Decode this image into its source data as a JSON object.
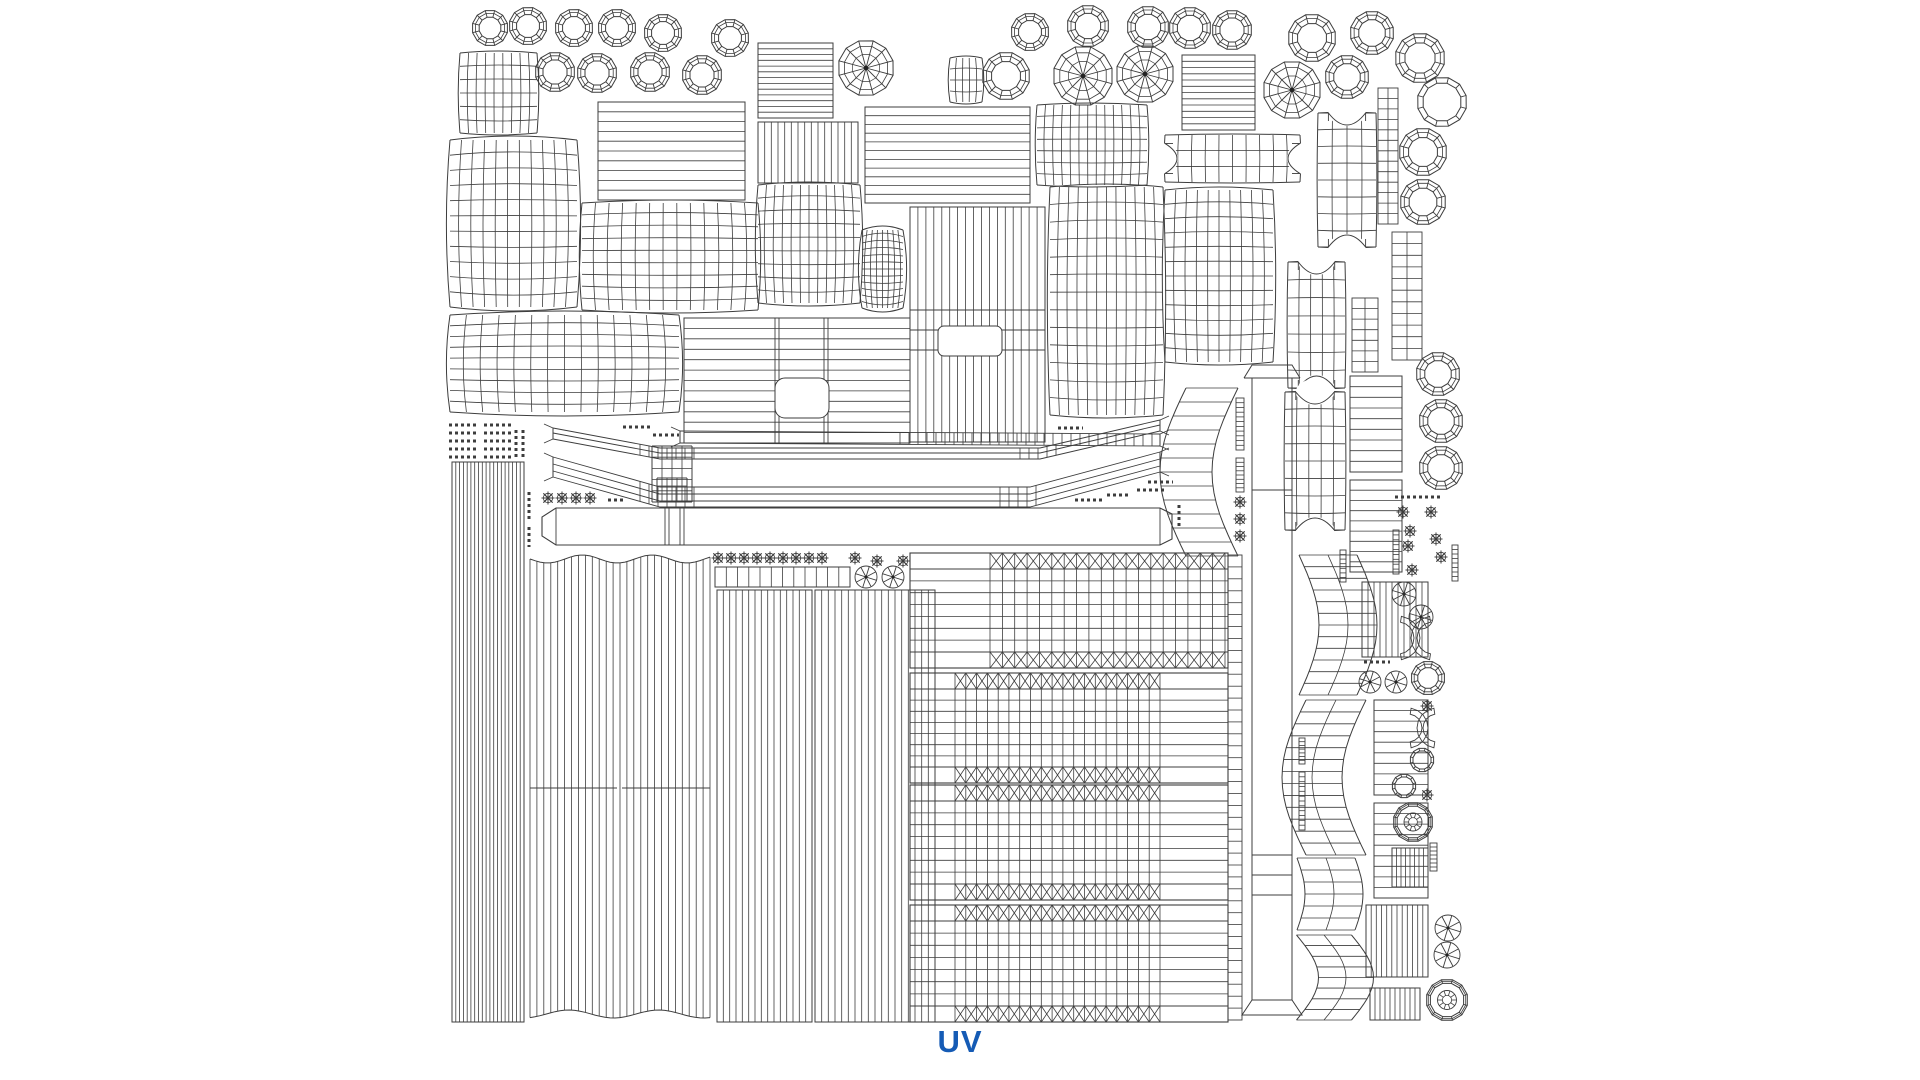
{
  "page": {
    "background": "#ffffff",
    "line_color": "#3d3d3d",
    "label": {
      "text": "UV",
      "color": "#155bb5"
    }
  },
  "canvas": {
    "width": 1920,
    "height": 1080,
    "shapes": [
      {
        "t": "ring",
        "x": 490,
        "y": 28,
        "r": 18
      },
      {
        "t": "ring",
        "x": 528,
        "y": 26,
        "r": 19
      },
      {
        "t": "ring",
        "x": 574,
        "y": 28,
        "r": 19
      },
      {
        "t": "ring",
        "x": 617,
        "y": 28,
        "r": 19
      },
      {
        "t": "ring",
        "x": 663,
        "y": 33,
        "r": 19
      },
      {
        "t": "ring",
        "x": 730,
        "y": 38,
        "r": 19
      },
      {
        "t": "ring",
        "x": 555,
        "y": 72,
        "r": 20
      },
      {
        "t": "ring",
        "x": 597,
        "y": 73,
        "r": 20
      },
      {
        "t": "ring",
        "x": 650,
        "y": 72,
        "r": 20
      },
      {
        "t": "ring",
        "x": 702,
        "y": 75,
        "r": 20
      },
      {
        "t": "ring",
        "x": 1030,
        "y": 32,
        "r": 19
      },
      {
        "t": "ring",
        "x": 1088,
        "y": 26,
        "r": 21
      },
      {
        "t": "ring",
        "x": 1148,
        "y": 27,
        "r": 21
      },
      {
        "t": "ring",
        "x": 1190,
        "y": 28,
        "r": 21
      },
      {
        "t": "ring",
        "x": 1232,
        "y": 30,
        "r": 20
      },
      {
        "t": "ring",
        "x": 1312,
        "y": 38,
        "r": 24
      },
      {
        "t": "ring",
        "x": 1372,
        "y": 33,
        "r": 22
      },
      {
        "t": "ring",
        "x": 1347,
        "y": 77,
        "r": 22
      },
      {
        "t": "ring",
        "x": 1420,
        "y": 58,
        "r": 25
      },
      {
        "t": "ring",
        "x": 1423,
        "y": 152,
        "r": 24
      },
      {
        "t": "ring",
        "x": 1423,
        "y": 202,
        "r": 23
      },
      {
        "t": "ring",
        "x": 1006,
        "y": 76,
        "r": 24
      },
      {
        "t": "ring",
        "x": 1438,
        "y": 374,
        "r": 22
      },
      {
        "t": "ring",
        "x": 1441,
        "y": 421,
        "r": 22
      },
      {
        "t": "ring",
        "x": 1441,
        "y": 468,
        "r": 22
      },
      {
        "t": "ring",
        "x": 1428,
        "y": 678,
        "r": 17
      },
      {
        "t": "ringp",
        "x": 1442,
        "y": 102,
        "r": 25
      },
      {
        "t": "ringp",
        "x": 1422,
        "y": 760,
        "r": 12
      },
      {
        "t": "ringp",
        "x": 1404,
        "y": 786,
        "r": 12
      },
      {
        "t": "bearing",
        "x": 1413,
        "y": 822,
        "r": 20
      },
      {
        "t": "bearing",
        "x": 1447,
        "y": 1000,
        "r": 21
      },
      {
        "t": "wheel",
        "x": 866,
        "y": 68,
        "r": 28
      },
      {
        "t": "wheel",
        "x": 1083,
        "y": 76,
        "r": 30
      },
      {
        "t": "wheel",
        "x": 1145,
        "y": 74,
        "r": 29
      },
      {
        "t": "wheel",
        "x": 1292,
        "y": 90,
        "r": 29
      },
      {
        "t": "wheelS",
        "x": 866,
        "y": 577,
        "r": 11
      },
      {
        "t": "wheelS",
        "x": 893,
        "y": 577,
        "r": 11
      },
      {
        "t": "wheelS",
        "x": 1370,
        "y": 682,
        "r": 11
      },
      {
        "t": "wheelS",
        "x": 1396,
        "y": 682,
        "r": 11
      },
      {
        "t": "wheelS",
        "x": 1404,
        "y": 594,
        "r": 12
      },
      {
        "t": "wheelS",
        "x": 1421,
        "y": 617,
        "r": 12
      },
      {
        "t": "wheelS",
        "x": 1448,
        "y": 928,
        "r": 13
      },
      {
        "t": "wheelS",
        "x": 1447,
        "y": 955,
        "r": 13
      },
      {
        "t": "flower",
        "x": 548,
        "y": 498
      },
      {
        "t": "flower",
        "x": 562,
        "y": 498
      },
      {
        "t": "flower",
        "x": 576,
        "y": 498
      },
      {
        "t": "flower",
        "x": 590,
        "y": 498
      },
      {
        "t": "flower",
        "x": 718,
        "y": 558
      },
      {
        "t": "flower",
        "x": 731,
        "y": 558
      },
      {
        "t": "flower",
        "x": 744,
        "y": 558
      },
      {
        "t": "flower",
        "x": 757,
        "y": 558
      },
      {
        "t": "flower",
        "x": 770,
        "y": 558
      },
      {
        "t": "flower",
        "x": 783,
        "y": 558
      },
      {
        "t": "flower",
        "x": 796,
        "y": 558
      },
      {
        "t": "flower",
        "x": 809,
        "y": 558
      },
      {
        "t": "flower",
        "x": 822,
        "y": 558
      },
      {
        "t": "flower",
        "x": 855,
        "y": 558
      },
      {
        "t": "flower",
        "x": 877,
        "y": 561
      },
      {
        "t": "flower",
        "x": 903,
        "y": 561
      },
      {
        "t": "flower",
        "x": 1240,
        "y": 502
      },
      {
        "t": "flower",
        "x": 1240,
        "y": 519
      },
      {
        "t": "flower",
        "x": 1240,
        "y": 536
      },
      {
        "t": "flower",
        "x": 1317,
        "y": 528
      },
      {
        "t": "flower",
        "x": 1403,
        "y": 512
      },
      {
        "t": "flower",
        "x": 1431,
        "y": 512
      },
      {
        "t": "flower",
        "x": 1410,
        "y": 531
      },
      {
        "t": "flower",
        "x": 1436,
        "y": 539
      },
      {
        "t": "flower",
        "x": 1408,
        "y": 546
      },
      {
        "t": "flower",
        "x": 1441,
        "y": 557
      },
      {
        "t": "flower",
        "x": 1412,
        "y": 570
      },
      {
        "t": "flower",
        "x": 1427,
        "y": 706
      },
      {
        "t": "flower",
        "x": 1427,
        "y": 795
      },
      {
        "t": "grid",
        "x": 460,
        "y": 53,
        "w": 77,
        "h": 80,
        "c": 9,
        "rw": 6,
        "wp": 2
      },
      {
        "t": "grid",
        "x": 450,
        "y": 140,
        "w": 127,
        "h": 167,
        "c": 11,
        "rw": 11,
        "wp": 4
      },
      {
        "t": "grid",
        "x": 582,
        "y": 203,
        "w": 176,
        "h": 107,
        "c": 13,
        "rw": 9,
        "wp": 3
      },
      {
        "t": "grid",
        "x": 758,
        "y": 185,
        "w": 102,
        "h": 118,
        "c": 12,
        "rw": 9,
        "wp": 3
      },
      {
        "t": "grid",
        "x": 862,
        "y": 230,
        "w": 41,
        "h": 78,
        "c": 8,
        "rw": 12,
        "wp": 4
      },
      {
        "t": "grid",
        "x": 1037,
        "y": 105,
        "w": 110,
        "h": 80,
        "c": 13,
        "rw": 7,
        "wp": 2
      },
      {
        "t": "grid",
        "x": 1050,
        "y": 187,
        "w": 113,
        "h": 228,
        "c": 12,
        "rw": 13,
        "wp": 3
      },
      {
        "t": "grid",
        "x": 1165,
        "y": 190,
        "w": 108,
        "h": 172,
        "c": 10,
        "rw": 12,
        "wp": 3
      },
      {
        "t": "grid",
        "x": 450,
        "y": 315,
        "w": 229,
        "h": 97,
        "c": 14,
        "rw": 9,
        "wp": 4
      },
      {
        "t": "grid",
        "x": 950,
        "y": 58,
        "w": 32,
        "h": 44,
        "c": 5,
        "rw": 4,
        "wp": 2
      },
      {
        "t": "grid",
        "x": 652,
        "y": 446,
        "w": 40,
        "h": 56,
        "c": 4,
        "rw": 5,
        "wp": 0
      },
      {
        "t": "grid",
        "x": 657,
        "y": 478,
        "w": 30,
        "h": 24,
        "c": 3,
        "rw": 3,
        "wp": 0
      },
      {
        "t": "hlines",
        "x": 598,
        "y": 102,
        "w": 147,
        "h": 98,
        "n": 9
      },
      {
        "t": "hlines",
        "x": 758,
        "y": 43,
        "w": 75,
        "h": 75,
        "n": 12
      },
      {
        "t": "hlines",
        "x": 865,
        "y": 107,
        "w": 165,
        "h": 96,
        "n": 10
      },
      {
        "t": "hlines",
        "x": 1182,
        "y": 55,
        "w": 73,
        "h": 75,
        "n": 11
      },
      {
        "t": "hlines",
        "x": 1350,
        "y": 376,
        "w": 52,
        "h": 96,
        "n": 8
      },
      {
        "t": "hlines",
        "x": 1350,
        "y": 480,
        "w": 52,
        "h": 92,
        "n": 8
      },
      {
        "t": "hlines",
        "x": 1374,
        "y": 700,
        "w": 54,
        "h": 95,
        "n": 8
      },
      {
        "t": "hlines",
        "x": 1374,
        "y": 803,
        "w": 54,
        "h": 95,
        "n": 8
      },
      {
        "t": "vlines",
        "x": 758,
        "y": 122,
        "w": 100,
        "h": 61,
        "n": 14
      },
      {
        "t": "vlines",
        "x": 452,
        "y": 462,
        "w": 72,
        "h": 560,
        "n": 18
      },
      {
        "t": "vlines",
        "x": 717,
        "y": 590,
        "w": 95,
        "h": 432,
        "n": 14
      },
      {
        "t": "vlines",
        "x": 815,
        "y": 590,
        "w": 120,
        "h": 432,
        "n": 17
      },
      {
        "t": "vlines",
        "x": 1362,
        "y": 582,
        "w": 66,
        "h": 75,
        "n": 10
      },
      {
        "t": "vlines",
        "x": 1366,
        "y": 905,
        "w": 62,
        "h": 72,
        "n": 11
      },
      {
        "t": "vlines",
        "x": 1370,
        "y": 988,
        "w": 50,
        "h": 32,
        "n": 9
      },
      {
        "t": "vlines",
        "x": 1392,
        "y": 848,
        "w": 36,
        "h": 39,
        "n": 7
      },
      {
        "t": "vlines",
        "x": 715,
        "y": 567,
        "w": 135,
        "h": 20,
        "n": 11
      },
      {
        "t": "vwavy",
        "x": 530,
        "y": 555,
        "w": 180,
        "h": 463,
        "n": 26
      },
      {
        "t": "seg",
        "pts": [
          [
            530,
            788,
            617,
            788
          ],
          [
            622,
            788,
            710,
            788
          ]
        ]
      },
      {
        "t": "tallblock",
        "x": 910,
        "y": 207,
        "w": 135,
        "h": 235,
        "hl": [
          310,
          330,
          350
        ],
        "win": [
          938,
          326,
          64,
          30
        ],
        "n": 16
      },
      {
        "t": "holeblock",
        "x": 684,
        "y": 318,
        "w": 226,
        "h": 125,
        "rw": 11,
        "dbl": [
          775,
          824
        ],
        "hole": [
          775,
          378,
          54,
          40
        ]
      },
      {
        "t": "axle",
        "x": 542,
        "y": 508,
        "w": 630,
        "h": 37,
        "div": [
          665,
          680
        ]
      },
      {
        "t": "pillar",
        "x": 1252,
        "y": 365,
        "w": 40,
        "h": 650
      },
      {
        "t": "band",
        "pts": [
          [
            553,
            428
          ],
          [
            660,
            448
          ],
          [
            1040,
            448
          ],
          [
            1160,
            420
          ]
        ],
        "offs": [
          0,
          5,
          11
        ],
        "ticks": [
          [
            640,
            700
          ],
          [
            1020,
            1060
          ]
        ]
      },
      {
        "t": "band",
        "pts": [
          [
            553,
            457
          ],
          [
            660,
            487
          ],
          [
            1030,
            487
          ],
          [
            1160,
            452
          ]
        ],
        "offs": [
          0,
          7,
          14,
          20
        ],
        "ticks": [
          [
            640,
            700
          ],
          [
            1000,
            1040
          ]
        ]
      },
      {
        "t": "band",
        "pts": [
          [
            680,
            431
          ],
          [
            1160,
            434
          ]
        ],
        "offs": [
          0,
          12
        ],
        "ticks": [
          [
            900,
            1155
          ]
        ]
      },
      {
        "t": "vband",
        "x": 1212,
        "y": 388,
        "h": 168,
        "w": 52,
        "b": -26,
        "n": 12,
        "c": 1
      },
      {
        "t": "vband",
        "x": 1328,
        "y": 555,
        "h": 140,
        "w": 58,
        "b": 20,
        "n": 12,
        "c": 2
      },
      {
        "t": "vband",
        "x": 1336,
        "y": 700,
        "h": 155,
        "w": 60,
        "b": -24,
        "n": 13,
        "c": 2
      },
      {
        "t": "vband",
        "x": 1326,
        "y": 858,
        "h": 72,
        "w": 58,
        "b": 8,
        "n": 6,
        "c": 2
      },
      {
        "t": "vband",
        "x": 1324,
        "y": 935,
        "h": 85,
        "w": 55,
        "b": 22,
        "n": 8,
        "c": 2
      },
      {
        "t": "boneh",
        "x": 1165,
        "y": 135,
        "w": 135,
        "h": 47,
        "c": 10,
        "rw": 3
      },
      {
        "t": "bonev",
        "x": 1318,
        "y": 113,
        "w": 58,
        "h": 134,
        "c": 4,
        "rw": 8
      },
      {
        "t": "bonev",
        "x": 1288,
        "y": 262,
        "w": 57,
        "h": 126,
        "c": 5,
        "rw": 7
      },
      {
        "t": "bonev",
        "x": 1285,
        "y": 392,
        "w": 60,
        "h": 138,
        "c": 5,
        "rw": 8
      },
      {
        "t": "ladder",
        "x": 1378,
        "y": 88,
        "w": 20,
        "h": 136,
        "n": 12,
        "c": 2
      },
      {
        "t": "ladder",
        "x": 1392,
        "y": 232,
        "w": 30,
        "h": 128,
        "n": 10,
        "c": 2
      },
      {
        "t": "ladder",
        "x": 1352,
        "y": 298,
        "w": 26,
        "h": 74,
        "n": 6,
        "c": 2
      },
      {
        "t": "ladder",
        "x": 1228,
        "y": 555,
        "w": 14,
        "h": 465,
        "n": 38,
        "c": 1
      },
      {
        "t": "ladder",
        "x": 1340,
        "y": 550,
        "w": 6,
        "h": 32,
        "n": 6,
        "c": 1
      },
      {
        "t": "ladder",
        "x": 1452,
        "y": 545,
        "w": 6,
        "h": 36,
        "n": 7,
        "c": 1
      },
      {
        "t": "ladder",
        "x": 1393,
        "y": 530,
        "w": 6,
        "h": 44,
        "n": 8,
        "c": 1
      },
      {
        "t": "ladder",
        "x": 1430,
        "y": 843,
        "w": 7,
        "h": 28,
        "n": 6,
        "c": 1
      },
      {
        "t": "ladder",
        "x": 1236,
        "y": 398,
        "w": 8,
        "h": 52,
        "n": 10,
        "c": 1
      },
      {
        "t": "ladder",
        "x": 1236,
        "y": 458,
        "w": 8,
        "h": 34,
        "n": 7,
        "c": 1
      },
      {
        "t": "ladder",
        "x": 1299,
        "y": 738,
        "w": 6,
        "h": 26,
        "n": 6,
        "c": 1
      },
      {
        "t": "ladder",
        "x": 1299,
        "y": 772,
        "w": 6,
        "h": 58,
        "n": 11,
        "c": 1
      },
      {
        "t": "dashrow",
        "x": 623,
        "y": 427,
        "len": 27
      },
      {
        "t": "dashrow",
        "x": 653,
        "y": 435,
        "len": 26
      },
      {
        "t": "dashrow",
        "x": 608,
        "y": 500,
        "len": 18
      },
      {
        "t": "dashrow",
        "x": 1058,
        "y": 428,
        "len": 25
      },
      {
        "t": "dashrow",
        "x": 1148,
        "y": 482,
        "len": 25
      },
      {
        "t": "dashrow",
        "x": 1137,
        "y": 490,
        "len": 28
      },
      {
        "t": "dashrow",
        "x": 1107,
        "y": 495,
        "len": 24
      },
      {
        "t": "dashrow",
        "x": 1075,
        "y": 500,
        "len": 27
      },
      {
        "t": "dashrow",
        "x": 1364,
        "y": 662,
        "len": 26
      },
      {
        "t": "dashrow",
        "x": 1395,
        "y": 497,
        "len": 45
      },
      {
        "t": "dashcol",
        "x": 516,
        "y": 430,
        "len": 28
      },
      {
        "t": "dashcol",
        "x": 523,
        "y": 430,
        "len": 28
      },
      {
        "t": "dashcol",
        "x": 529,
        "y": 492,
        "len": 30
      },
      {
        "t": "dashcol",
        "x": 529,
        "y": 527,
        "len": 20
      },
      {
        "t": "dashcol",
        "x": 1179,
        "y": 505,
        "len": 24
      },
      {
        "t": "dashcluster",
        "x": 449,
        "y": 425,
        "c": 2,
        "rw": 5,
        "dw": 29,
        "gx": 35,
        "gy": 8
      },
      {
        "t": "tread",
        "x": 910,
        "y": 553,
        "w": 318,
        "h": 115,
        "bx1": 990,
        "bx2": 1225,
        "c": 19
      },
      {
        "t": "tread",
        "x": 910,
        "y": 673,
        "w": 318,
        "h": 110,
        "bx1": 955,
        "bx2": 1160,
        "c": 19
      },
      {
        "t": "tread",
        "x": 910,
        "y": 785,
        "w": 318,
        "h": 115,
        "bx1": 955,
        "bx2": 1160,
        "c": 19
      },
      {
        "t": "tread",
        "x": 910,
        "y": 905,
        "w": 318,
        "h": 117,
        "bx1": 955,
        "bx2": 1160,
        "c": 19
      },
      {
        "t": "ccurve",
        "x": 1433,
        "y": 638,
        "r": 22,
        "s": "l"
      },
      {
        "t": "ccurve",
        "x": 1398,
        "y": 638,
        "r": 22,
        "s": "r"
      },
      {
        "t": "ccurve",
        "x": 1437,
        "y": 728,
        "r": 20,
        "s": "l"
      },
      {
        "t": "ccurve",
        "x": 1408,
        "y": 728,
        "r": 20,
        "s": "r"
      }
    ]
  }
}
